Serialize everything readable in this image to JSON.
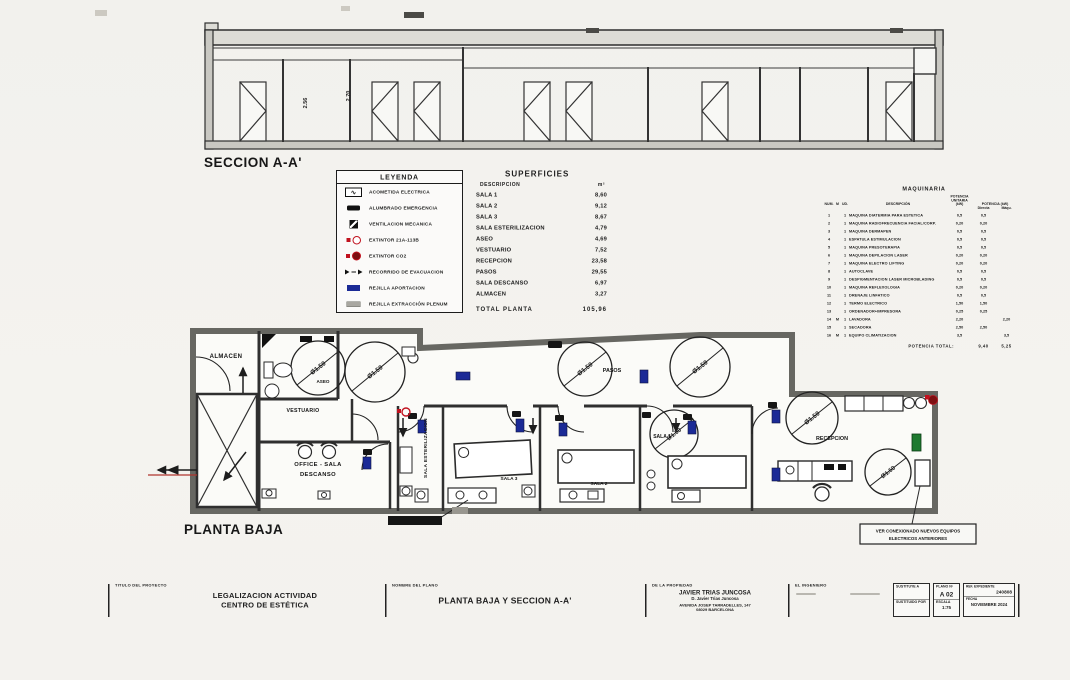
{
  "section": {
    "label": "SECCION A-A'",
    "dim1": "2.56",
    "dim2": "2.70"
  },
  "plan": {
    "label": "PLANTA BAJA",
    "circle_label": "Ø1.50",
    "rooms": {
      "almacen": "ALMACEN",
      "aseo": "ASEO",
      "vestuario": "VESTUARIO",
      "office_line1": "OFFICE - SALA",
      "office_line2": "DESCANSO",
      "esterilizacion": "SALA ESTERILIZACION",
      "sala1": "SALA 1",
      "sala2": "SALA 2",
      "sala3": "SALA 3",
      "pasos": "PASOS",
      "recepcion": "RECEPCION"
    },
    "note_line1": "VER CONEXIONADO NUEVOS EQUIPOS",
    "note_line2": "ELECTRICOS ANTERIORES"
  },
  "legend": {
    "title": "LEYENDA",
    "items": [
      {
        "icon": "acometida-electrica",
        "label": "ACOMETIDA ELECTRICA"
      },
      {
        "icon": "alumbrado-emergencia",
        "label": "ALUMBRADO EMERGENCIA"
      },
      {
        "icon": "ventilacion-mecanica",
        "label": "VENTILACION MECANICA"
      },
      {
        "icon": "extintor-21a",
        "label": "EXTINTOR 21A-113B"
      },
      {
        "icon": "extintor-co2",
        "label": "EXTINTOR CO2"
      },
      {
        "icon": "recorrido-evacuacion",
        "label": "RECORRIDO DE EVACUACION"
      },
      {
        "icon": "rejilla-aportacion",
        "label": "REJILLA APORTACION"
      },
      {
        "icon": "rejilla-extraccion",
        "label": "REJILLA EXTRACCIÓN PLENUM"
      }
    ]
  },
  "superficies": {
    "title": "SUPERFICIES",
    "col_desc": "DESCRIPCION",
    "col_m2": "m²",
    "rows": [
      [
        "SALA 1",
        "8,60"
      ],
      [
        "SALA 2",
        "9,12"
      ],
      [
        "SALA 3",
        "8,67"
      ],
      [
        "SALA ESTERILIZACION",
        "4,79"
      ],
      [
        "ASEO",
        "4,69"
      ],
      [
        "VESTUARIO",
        "7,52"
      ],
      [
        "RECEPCION",
        "23,58"
      ],
      [
        "PASOS",
        "29,55"
      ],
      [
        "SALA DESCANSO",
        "6,97"
      ],
      [
        "ALMACEN",
        "3,27"
      ]
    ],
    "total_label": "TOTAL PLANTA",
    "total_value": "105,96"
  },
  "maquinaria": {
    "title": "MAQUINARIA",
    "h_num": "NUM.",
    "h_m": "M",
    "h_ud": "UD.",
    "h_desc": "DESCRIPCIÓN",
    "h_unit1": "POTENCIA",
    "h_unit2": "UNITARIA",
    "h_unit3": "(kW)",
    "h_pot": "POTENCIA (kW)",
    "h_directa": "Directa",
    "h_maqu": "Máqu.",
    "rows": [
      [
        "1",
        "",
        "1",
        "MAQUINA DIATERMIA PARA ESTETICA",
        "0,5",
        "0,5",
        ""
      ],
      [
        "2",
        "",
        "1",
        "MAQUINA RADIOFRECUENCIA FACIAL/CORP.",
        "0,20",
        "0,20",
        ""
      ],
      [
        "3",
        "",
        "1",
        "MAQUINA DERMAPEN",
        "0,5",
        "0,5",
        ""
      ],
      [
        "4",
        "",
        "1",
        "ESPATULA ESTIMULACION",
        "0,5",
        "0,5",
        ""
      ],
      [
        "5",
        "",
        "1",
        "MAQUINA PRESOTERAPIA",
        "0,5",
        "0,5",
        ""
      ],
      [
        "6",
        "",
        "1",
        "MAQUINA DEPILACION LASER",
        "0,20",
        "0,20",
        ""
      ],
      [
        "7",
        "",
        "1",
        "MAQUINA ELECTRO LIFTING",
        "0,20",
        "0,20",
        ""
      ],
      [
        "8",
        "",
        "1",
        "AUTOCLAVE",
        "0,5",
        "0,5",
        ""
      ],
      [
        "9",
        "",
        "1",
        "DESPIGMENTACION LASER MICROBLADING",
        "0,5",
        "0,5",
        ""
      ],
      [
        "10",
        "",
        "1",
        "MAQUINA REFLEXOLOGIA",
        "0,20",
        "0,20",
        ""
      ],
      [
        "11",
        "",
        "1",
        "DRENAJE LINFATICO",
        "0,5",
        "0,5",
        ""
      ],
      [
        "12",
        "",
        "1",
        "TERMO ELECTRICO",
        "1,50",
        "1,50",
        ""
      ],
      [
        "13",
        "",
        "1",
        "ORDENADOR+IMPRESORA",
        "0,25",
        "0,25",
        ""
      ],
      [
        "14",
        "M",
        "1",
        "LAVADORA",
        "2,20",
        "",
        "2,20"
      ],
      [
        "15",
        "",
        "1",
        "SECADORA",
        "2,50",
        "2,50",
        ""
      ],
      [
        "16",
        "M",
        "1",
        "EQUIPO CLIMATIZACION",
        "3,5",
        "",
        "3,5"
      ]
    ],
    "total_label": "POTENCIA TOTAL:",
    "total_directa": "9,40",
    "total_maqu": "5,25"
  },
  "titleblock": {
    "titulo_label": "TITULO DEL PROYECTO",
    "titulo_line1": "LEGALIZACION ACTIVIDAD",
    "titulo_line2": "CENTRO DE ESTÉTICA",
    "plano_label": "NOMBRE DEL PLANO",
    "plano_nombre": "PLANTA BAJA Y SECCION A-A'",
    "propiedad_label": "DE LA PROPIEDAD",
    "propiedad_nombre": "JAVIER TRIAS JUNCOSA",
    "propiedad_sub": "D. Javier Trias Juncosa",
    "propiedad_dir1": "AVENIDA JOSEP TARRADELLES, 147",
    "propiedad_dir2": "08029 BARCELONA",
    "ingeniero_label": "EL INGENIERO",
    "sustituye_label": "SUSTITUYE A",
    "sustituido_label": "SUSTITUIDO POR",
    "plano_num_label": "PLANO Nº",
    "plano_num": "A 02",
    "escala_label": "ESCALA",
    "escala": "1:75",
    "expediente_label": "REF. EXPEDIENTE",
    "expediente": "240808",
    "fecha_label": "FECHA",
    "fecha": "NOVIEMBRE 2024"
  }
}
